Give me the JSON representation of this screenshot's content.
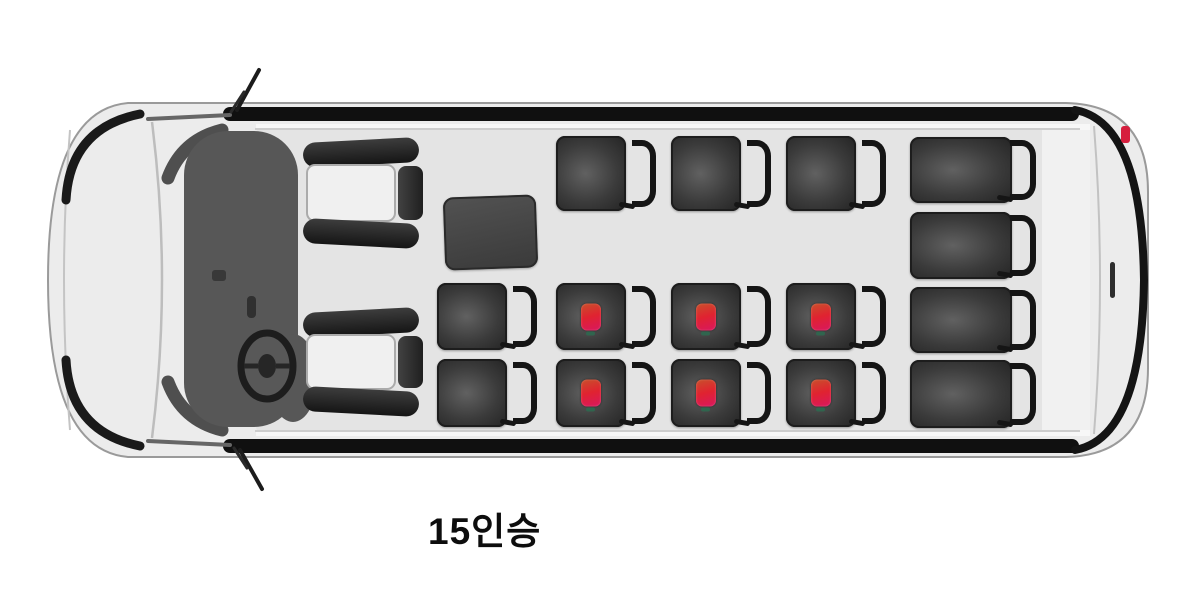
{
  "image": {
    "width": 1200,
    "height": 594,
    "background": "#ffffff"
  },
  "vehicle": {
    "view": "top-view-van-front-facing-left",
    "capacity_label": "15인승",
    "body_color": "#ececec",
    "floor_color": "#e4e4e4",
    "seat_color": "#3b3b3b",
    "front_seat_pad_color": "#f0f0f0",
    "marker_color": "#e02330",
    "tail_light_color": "#d61f3e",
    "marker_count": 6,
    "seat_count": 17
  },
  "cabin": {
    "storage_box": {
      "x": 444,
      "y": 196,
      "w": 93,
      "h": 73
    }
  },
  "seats": [
    {
      "id": "front-passenger",
      "kind": "front",
      "x": 303,
      "y": 140,
      "w": 120,
      "h": 106,
      "marker": false
    },
    {
      "id": "driver",
      "kind": "front",
      "x": 303,
      "y": 310,
      "w": 120,
      "h": 104,
      "marker": false
    },
    {
      "id": "row2-center",
      "kind": "passenger",
      "x": 437,
      "y": 283,
      "w": 100,
      "h": 67,
      "marker": false
    },
    {
      "id": "row2-left",
      "kind": "passenger",
      "x": 437,
      "y": 359,
      "w": 100,
      "h": 68,
      "marker": false
    },
    {
      "id": "row3-right",
      "kind": "passenger",
      "x": 556,
      "y": 136,
      "w": 100,
      "h": 75,
      "marker": false
    },
    {
      "id": "row3-center",
      "kind": "passenger",
      "x": 556,
      "y": 283,
      "w": 100,
      "h": 67,
      "marker": true
    },
    {
      "id": "row3-left",
      "kind": "passenger",
      "x": 556,
      "y": 359,
      "w": 100,
      "h": 68,
      "marker": true
    },
    {
      "id": "row4-right",
      "kind": "passenger",
      "x": 671,
      "y": 136,
      "w": 100,
      "h": 75,
      "marker": false
    },
    {
      "id": "row4-center",
      "kind": "passenger",
      "x": 671,
      "y": 283,
      "w": 100,
      "h": 67,
      "marker": true
    },
    {
      "id": "row4-left",
      "kind": "passenger",
      "x": 671,
      "y": 359,
      "w": 100,
      "h": 68,
      "marker": true
    },
    {
      "id": "row5-right",
      "kind": "passenger",
      "x": 786,
      "y": 136,
      "w": 100,
      "h": 75,
      "marker": false
    },
    {
      "id": "row5-center",
      "kind": "passenger",
      "x": 786,
      "y": 283,
      "w": 100,
      "h": 67,
      "marker": true
    },
    {
      "id": "row5-left",
      "kind": "passenger",
      "x": 786,
      "y": 359,
      "w": 100,
      "h": 68,
      "marker": true
    },
    {
      "id": "bench-1",
      "kind": "bench",
      "x": 910,
      "y": 137,
      "w": 126,
      "h": 66,
      "marker": false
    },
    {
      "id": "bench-2",
      "kind": "bench",
      "x": 910,
      "y": 212,
      "w": 126,
      "h": 67,
      "marker": false
    },
    {
      "id": "bench-3",
      "kind": "bench",
      "x": 910,
      "y": 287,
      "w": 126,
      "h": 66,
      "marker": false
    },
    {
      "id": "bench-4",
      "kind": "bench",
      "x": 910,
      "y": 360,
      "w": 126,
      "h": 68,
      "marker": false
    }
  ]
}
